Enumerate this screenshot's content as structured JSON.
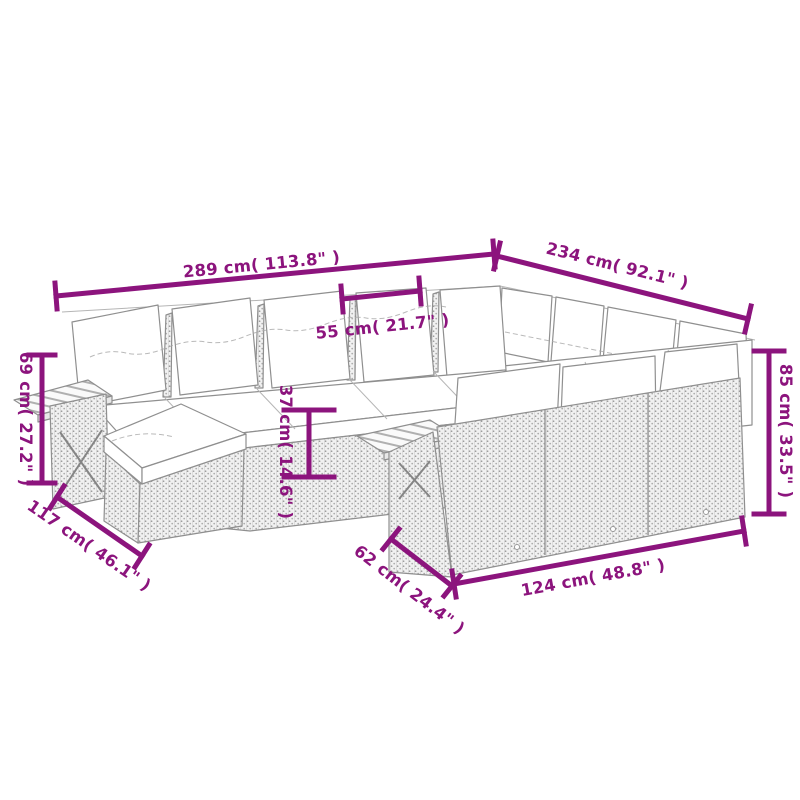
{
  "diagram": {
    "colors": {
      "dimension_accent": "#8c147d",
      "line_art": "#8f8f8f",
      "rattan_dot": "#9a9a9a",
      "cushion": "#ffffff"
    },
    "dimensions": {
      "total_width": {
        "label": "289 cm( 113.8\" )"
      },
      "total_depth": {
        "label": "234 cm( 92.1\" )"
      },
      "seat_width": {
        "label": "55 cm( 21.7\" )"
      },
      "arm_height": {
        "label": "69 cm( 27.2\" )"
      },
      "seat_height": {
        "label": "37 cm( 14.6\" )"
      },
      "back_height": {
        "label": "85 cm( 33.5\" )"
      },
      "side_depth": {
        "label": "117 cm( 46.1\" )"
      },
      "module_depth": {
        "label": "62 cm( 24.4\" )"
      },
      "front_width": {
        "label": "124 cm( 48.8\" )"
      }
    }
  }
}
